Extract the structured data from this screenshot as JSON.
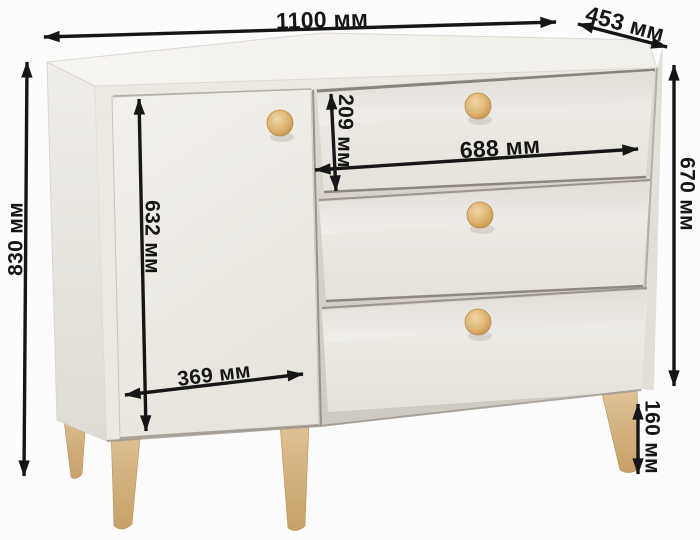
{
  "unit": "мм",
  "dimensions": {
    "width": {
      "label": "1100 мм",
      "value": 1100
    },
    "depth": {
      "label": "453 мм",
      "value": 453
    },
    "height": {
      "label": "830 мм",
      "value": 830
    },
    "door_height": {
      "label": "632 мм",
      "value": 632
    },
    "door_width": {
      "label": "369 мм",
      "value": 369
    },
    "top_drawer_height": {
      "label": "209 мм",
      "value": 209
    },
    "drawer_width": {
      "label": "688 мм",
      "value": 688
    },
    "carcass_height": {
      "label": "670 мм",
      "value": 670
    },
    "leg_height": {
      "label": "160 мм",
      "value": 160
    }
  },
  "colors": {
    "background": "#fcfcfc",
    "body_front": "#ece9e3",
    "body_side": "#e9e6e0",
    "body_top": "#f5f3ef",
    "recess": "#d9d5ce",
    "knob_wood": "#d8ab67",
    "leg_wood": "#d3af7c",
    "dimension_ink": "#161616"
  }
}
